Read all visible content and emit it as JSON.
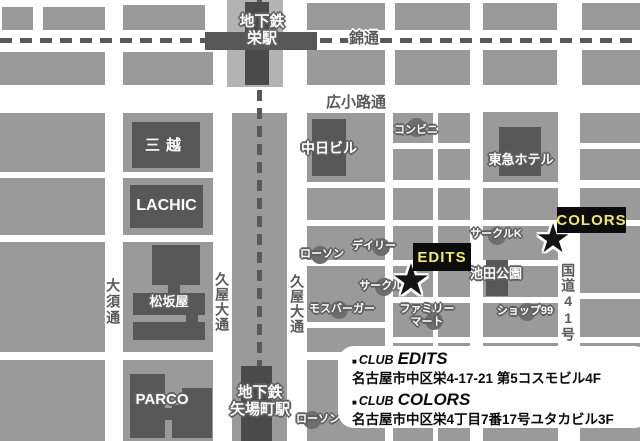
{
  "stations": {
    "sakae_line1": "地下鉄",
    "sakae_line2": "栄駅",
    "yabacho_line1": "地下鉄",
    "yabacho_line2": "矢場町駅"
  },
  "streets": {
    "nishiki": "錦通",
    "hirokoji": "広小路通",
    "osu": "大須通",
    "hisaya_left": "久屋大通",
    "hisaya_right": "久屋大通",
    "route41": "国道41号"
  },
  "buildings": {
    "mitsukoshi": "三越",
    "lachic": "LACHIC",
    "chunichi": "中日ビル",
    "tokyu_hotel": "東急ホテル",
    "matsuzakaya": "松坂屋",
    "parco": "PARCO",
    "ikeda_park": "池田公園"
  },
  "pois": {
    "conbini": "コンビニ",
    "lawson_1": "ローソン",
    "daily": "デイリー",
    "circlek_1": "サークルK",
    "circlek_2": "サークルK",
    "mos_burger": "モスバーガー",
    "familymart_line1": "ファミリー",
    "familymart_line2": "マート",
    "shop99": "ショップ99",
    "lawson_2": "ローソン"
  },
  "venues": {
    "edits": "EDITS",
    "colors": "COLORS"
  },
  "icons": {
    "star": "★"
  },
  "legend": {
    "entries": [
      {
        "bullet": "■",
        "club": "CLUB",
        "name": "EDITS",
        "address": "名古屋市中区栄4-17-21 第5コスモビル4F"
      },
      {
        "bullet": "■",
        "club": "CLUB",
        "name": "COLORS",
        "address": "名古屋市中区栄4丁目7番17号ユタカビル3F"
      }
    ]
  },
  "colors": {
    "city_block": "#9a9a9a",
    "road_dark": "#595959",
    "station_dark": "#4a4a4a",
    "station_area": "#b3b3b3",
    "accent_yellow": "#f2e95e",
    "venue_box_bg": "#0c0c0c",
    "background": "#ffffff"
  }
}
